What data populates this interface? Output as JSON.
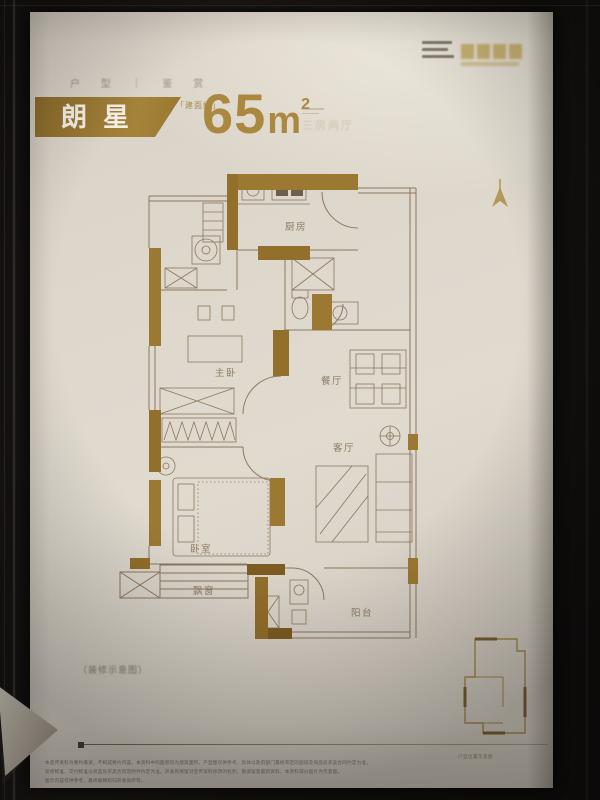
{
  "header": {
    "series_label": "户 型 ｜ 鉴 赏",
    "unit_name": "朗星",
    "area_prefix": "「建面约」",
    "area_value": "65",
    "area_unit": "m",
    "area_sup": "2",
    "rooms_hint": "三房两厅",
    "banner_gold": "#97762f",
    "number_gold": "#ab8840"
  },
  "brand": {
    "mark_icon": "brand-gold-seal",
    "mark_color": "#c2a65a"
  },
  "icons": {
    "north_arrow": "north-arrow-icon"
  },
  "plan": {
    "wall_color": "#9c7933",
    "line_color": "#8b775f",
    "rooms": [
      {
        "id": "kitchen",
        "label": "厨房"
      },
      {
        "id": "master-bedroom",
        "label": "主卧"
      },
      {
        "id": "dining",
        "label": "餐厅"
      },
      {
        "id": "living",
        "label": "客厅"
      },
      {
        "id": "bedroom",
        "label": "卧室"
      },
      {
        "id": "bay-window",
        "label": "飘窗"
      },
      {
        "id": "balcony",
        "label": "阳台"
      }
    ]
  },
  "keyplan": {
    "caption": "户型位置示意图",
    "color": "#a3884a"
  },
  "footer": {
    "caption": "（装修示意图）",
    "disclaimer_lines": [
      "本宣传资料为要约邀请，不构成要约内容。本资料中的面积均为建筑面积，户型图仅供参考，具体以政府部门最终审定的图纸及商品房买卖合同约定为准。",
      "装修标准、交付标准以商品房买卖合同及附件约定为准。开发商保留对宣传资料修改的权利，敬请留意最新资料，本资料部分图片为示意图。",
      "图示内容仅供参考，最终解释权归开发商所有。"
    ]
  }
}
